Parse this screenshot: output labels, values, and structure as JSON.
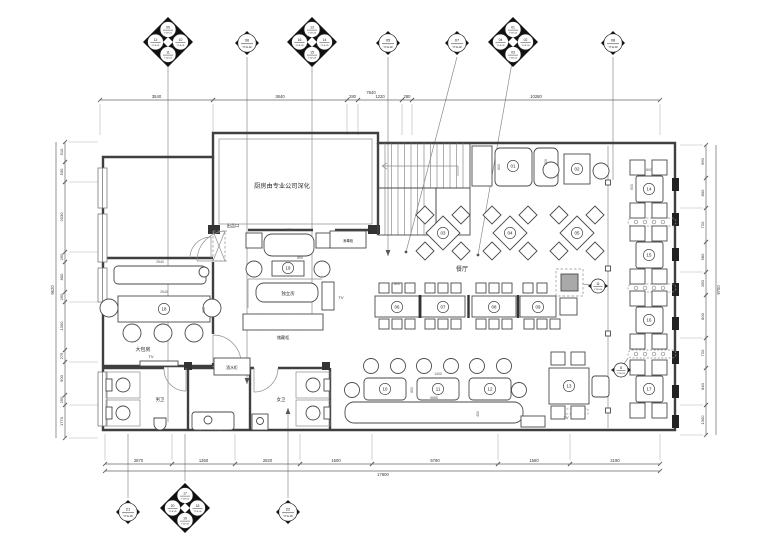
{
  "colors": {
    "wall": "#3f3f3f",
    "furniture": "#4a4a4a",
    "thin": "#8c8c8c",
    "dim_line": "#666666",
    "dim_text": "#333333",
    "marker_fill": "#111111",
    "station_gray": "#a9a9a9"
  },
  "rooms": {
    "kitchen": "厨房由专业公司深化",
    "serving_port": "出品口",
    "dining_hall": "餐厅",
    "large_private_room": "大包房",
    "private_room": "独立房",
    "storage_cabinet": "储藏柜",
    "drink_cabinet": "酒水柜",
    "sanitizer_cabinet": "消毒柜",
    "mens_toilet": "男卫",
    "womens_toilet": "女卫",
    "tv": "TV"
  },
  "room_labels": [
    {
      "key": "kitchen",
      "x": 282,
      "y": 188,
      "f": 6.2
    },
    {
      "key": "serving_port",
      "x": 233,
      "y": 227,
      "f": 4.2
    },
    {
      "key": "sanitizer_cabinet",
      "x": 348,
      "y": 242,
      "f": 3.6
    },
    {
      "key": "dining_hall",
      "x": 462,
      "y": 271,
      "f": 6.0
    },
    {
      "key": "large_private_room",
      "x": 143,
      "y": 351,
      "f": 5.0
    },
    {
      "key": "private_room",
      "x": 288,
      "y": 295,
      "f": 4.4
    },
    {
      "key": "storage_cabinet",
      "x": 283,
      "y": 339,
      "f": 4.2
    },
    {
      "key": "drink_cabinet",
      "x": 232,
      "y": 369,
      "f": 3.8
    },
    {
      "key": "mens_toilet",
      "x": 160,
      "y": 401,
      "f": 4.4
    },
    {
      "key": "womens_toilet",
      "x": 281,
      "y": 401,
      "f": 4.4
    }
  ],
  "tv_labels": [
    {
      "x": 151,
      "y": 358
    },
    {
      "x": 341,
      "y": 299
    },
    {
      "x": 566,
      "y": 419
    }
  ],
  "tables": [
    {
      "n": "01",
      "x": 513,
      "y": 166
    },
    {
      "n": "02",
      "x": 577,
      "y": 169
    },
    {
      "n": "03",
      "x": 443,
      "y": 233
    },
    {
      "n": "04",
      "x": 510,
      "y": 233
    },
    {
      "n": "05",
      "x": 577,
      "y": 233
    },
    {
      "n": "06",
      "x": 397,
      "y": 307
    },
    {
      "n": "07",
      "x": 443,
      "y": 307
    },
    {
      "n": "08",
      "x": 494,
      "y": 307
    },
    {
      "n": "09",
      "x": 538,
      "y": 307
    },
    {
      "n": "10",
      "x": 385,
      "y": 389
    },
    {
      "n": "11",
      "x": 438,
      "y": 389
    },
    {
      "n": "12",
      "x": 490,
      "y": 389
    },
    {
      "n": "13",
      "x": 569,
      "y": 386
    },
    {
      "n": "14",
      "x": 649,
      "y": 189
    },
    {
      "n": "15",
      "x": 649,
      "y": 255
    },
    {
      "n": "16",
      "x": 649,
      "y": 320
    },
    {
      "n": "17",
      "x": 649,
      "y": 389
    },
    {
      "n": "18",
      "x": 164,
      "y": 309
    },
    {
      "n": "19",
      "x": 288,
      "y": 268
    }
  ],
  "interior_dims": [
    {
      "x": 160,
      "y": 263,
      "t": "2540",
      "r": 0
    },
    {
      "x": 164,
      "y": 293,
      "t": "2540",
      "r": 0
    },
    {
      "x": 205,
      "y": 310,
      "t": "800",
      "r": 1
    },
    {
      "x": 289,
      "y": 231,
      "t": "1720",
      "r": 0
    },
    {
      "x": 300,
      "y": 259,
      "t": "800",
      "r": 0
    },
    {
      "x": 397,
      "y": 285,
      "t": "800",
      "r": 0
    },
    {
      "x": 500,
      "y": 167,
      "t": "800",
      "r": 1
    },
    {
      "x": 547,
      "y": 162,
      "t": "300",
      "r": 1
    },
    {
      "x": 438,
      "y": 375,
      "t": "1400",
      "r": 0
    },
    {
      "x": 413,
      "y": 390,
      "t": "800",
      "r": 1
    },
    {
      "x": 434,
      "y": 399,
      "t": "5685",
      "r": 0
    },
    {
      "x": 479,
      "y": 414,
      "t": "450",
      "r": 1
    },
    {
      "x": 649,
      "y": 171,
      "t": "800",
      "r": 0
    },
    {
      "x": 633,
      "y": 187,
      "t": "600",
      "r": 1
    }
  ],
  "dimensions": {
    "top": {
      "y": 100,
      "x1": 100,
      "x2": 660,
      "segs": [
        {
          "a": 100,
          "b": 213,
          "t": "3540"
        },
        {
          "a": 213,
          "b": 347,
          "t": "3640"
        },
        {
          "a": 347,
          "b": 358,
          "t": "280"
        },
        {
          "a": 358,
          "b": 402,
          "t": "1220"
        },
        {
          "a": 402,
          "b": 412,
          "t": "280"
        },
        {
          "a": 412,
          "b": 660,
          "t": "10280"
        }
      ],
      "overall": {
        "t": "7640",
        "x": 371,
        "y": 94
      }
    },
    "bottom": {
      "y": 464,
      "x1": 105,
      "x2": 660,
      "segs": [
        {
          "a": 105,
          "b": 172,
          "t": "2870"
        },
        {
          "a": 172,
          "b": 235,
          "t": "1360"
        },
        {
          "a": 235,
          "b": 300,
          "t": "2820"
        },
        {
          "a": 300,
          "b": 372,
          "t": "1500"
        },
        {
          "a": 372,
          "b": 498,
          "t": "5790"
        },
        {
          "a": 498,
          "b": 570,
          "t": "1560"
        },
        {
          "a": 570,
          "b": 660,
          "t": "2190"
        }
      ],
      "overall": {
        "t": "17600",
        "y": 471
      }
    },
    "left": {
      "x": 65,
      "y1": 142,
      "y2": 438,
      "segs": [
        {
          "a": 142,
          "b": 162,
          "t": "510"
        },
        {
          "a": 162,
          "b": 182,
          "t": "530"
        },
        {
          "a": 182,
          "b": 252,
          "t": "2030"
        },
        {
          "a": 252,
          "b": 262,
          "t": "260"
        },
        {
          "a": 262,
          "b": 292,
          "t": "800"
        },
        {
          "a": 292,
          "b": 302,
          "t": "260"
        },
        {
          "a": 302,
          "b": 350,
          "t": "1300"
        },
        {
          "a": 350,
          "b": 362,
          "t": "275"
        },
        {
          "a": 362,
          "b": 395,
          "t": "900"
        },
        {
          "a": 395,
          "b": 405,
          "t": "250"
        },
        {
          "a": 405,
          "b": 438,
          "t": "1770"
        }
      ],
      "overall": {
        "t": "9620",
        "x": 56
      }
    },
    "right": {
      "x": 706,
      "y1": 145,
      "y2": 435,
      "segs": [
        {
          "a": 145,
          "b": 178,
          "t": "960"
        },
        {
          "a": 178,
          "b": 208,
          "t": "800"
        },
        {
          "a": 208,
          "b": 242,
          "t": "720"
        },
        {
          "a": 242,
          "b": 272,
          "t": "580"
        },
        {
          "a": 272,
          "b": 295,
          "t": "280"
        },
        {
          "a": 295,
          "b": 338,
          "t": "800"
        },
        {
          "a": 338,
          "b": 368,
          "t": "720"
        },
        {
          "a": 368,
          "b": 405,
          "t": "840"
        },
        {
          "a": 405,
          "b": 435,
          "t": "1300"
        }
      ],
      "overall": {
        "t": "9700",
        "x": 716
      }
    }
  },
  "markers": {
    "top": [
      {
        "x": 168,
        "y": 42,
        "type": "cluster",
        "circles": [
          {
            "n": "09",
            "s": "YT-E-01"
          },
          {
            "n": "12",
            "s": "YT-E-01"
          },
          {
            "n": "10",
            "s": "YT-E-01"
          },
          {
            "n": "11",
            "s": "YT-E-01"
          }
        ]
      },
      {
        "x": 247,
        "y": 43,
        "type": "single",
        "circles": [
          {
            "n": "06",
            "s": "YT-E-02"
          }
        ]
      },
      {
        "x": 312,
        "y": 42,
        "type": "cluster",
        "circles": [
          {
            "n": "13",
            "s": "YT-E-03"
          },
          {
            "n": "16",
            "s": "YT-E-03"
          },
          {
            "n": "14",
            "s": "YT-E-03"
          },
          {
            "n": "15",
            "s": "YT-E-03"
          }
        ]
      },
      {
        "x": 388,
        "y": 43,
        "type": "single",
        "circles": [
          {
            "n": "05",
            "s": "YT-E-02"
          }
        ]
      },
      {
        "x": 457,
        "y": 43,
        "type": "single",
        "circles": [
          {
            "n": "07",
            "s": "YT-E-02"
          }
        ]
      },
      {
        "x": 513,
        "y": 42,
        "type": "cluster",
        "circles": [
          {
            "n": "01",
            "s": "YT-E-04"
          },
          {
            "n": "04",
            "s": "YT-E-04"
          },
          {
            "n": "02",
            "s": "YT-E-04"
          },
          {
            "n": "03",
            "s": "YT-E-04"
          }
        ]
      },
      {
        "x": 613,
        "y": 43,
        "type": "single",
        "circles": [
          {
            "n": "08",
            "s": "YT-E-02"
          }
        ]
      }
    ],
    "bottom": [
      {
        "x": 128,
        "y": 512,
        "type": "single",
        "circles": [
          {
            "n": "21",
            "s": "YT-E-05"
          }
        ]
      },
      {
        "x": 185,
        "y": 508,
        "type": "cluster",
        "circles": [
          {
            "n": "17",
            "s": "YT-E-05"
          },
          {
            "n": "20",
            "s": "YT-E-05"
          },
          {
            "n": "18",
            "s": "YT-E-05"
          },
          {
            "n": "19",
            "s": "YT-E-05"
          }
        ]
      },
      {
        "x": 288,
        "y": 512,
        "type": "single",
        "circles": [
          {
            "n": "22",
            "s": "YT-E-05"
          }
        ]
      }
    ],
    "inplan": [
      {
        "x": 598,
        "y": 286,
        "n": "11",
        "s": "YT-E-06"
      },
      {
        "x": 621,
        "y": 370,
        "n": "8",
        "s": "YT-E-06"
      }
    ]
  }
}
